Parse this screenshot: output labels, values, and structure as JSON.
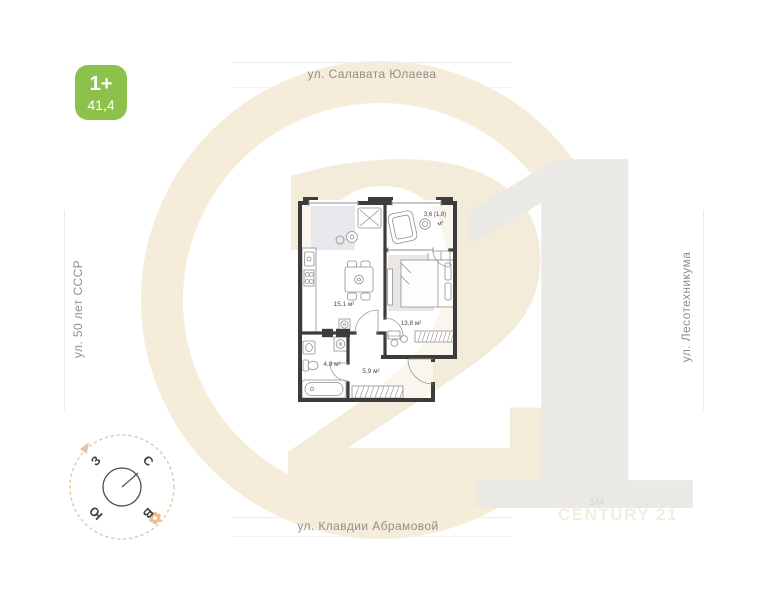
{
  "badge": {
    "label": "1+",
    "area": "41,4"
  },
  "streets": {
    "top": "ул. Салавата Юлаева",
    "left": "ул. 50 лет СССР",
    "right": "ул. Лесотехникума",
    "bottom": "ул. Клавдии Абрамовой"
  },
  "compass": {
    "north": "С",
    "east": "В",
    "south": "Ю",
    "west": "З"
  },
  "plan": {
    "balcony_area": "3,6 (1,8)",
    "balcony_unit": "м²",
    "kitchen_living_area": "15,1 м²",
    "bedroom_area": "13,8 м²",
    "bathroom_area": "4,8 м²",
    "hallway_area": "5,9 м²"
  },
  "watermark": {
    "digit_left": "2",
    "digit_right": "1",
    "brand_mark": "SM",
    "brand_name": "CENTURY 21"
  },
  "colors": {
    "badge_green": "#8cc24c",
    "wall_dark": "#3c3c3c",
    "ring_cream": "#f5edda",
    "digit_beige": "#f4ecda",
    "digit_gray": "#eae9e5",
    "compass_tan": "#e2c6a6",
    "street_gray": "#8f8e89"
  }
}
